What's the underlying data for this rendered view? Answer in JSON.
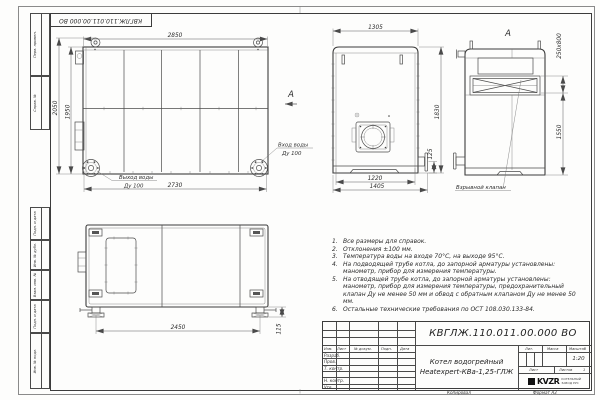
{
  "sheet": {
    "doc_number_mirrored": "КВГЛЖ.110.011.00.000 ВО",
    "copied_label": "Копировал",
    "format_label": "Формат А3"
  },
  "margin": {
    "items": [
      {
        "label": "Перв. примен."
      },
      {
        "label": "Справ. №"
      },
      {
        "label": "Подп. и дата"
      },
      {
        "label": "Инв. № дубл."
      },
      {
        "label": "Взам. инв. №"
      },
      {
        "label": "Подп. и дата"
      },
      {
        "label": "Инв. № подл."
      }
    ]
  },
  "front_view": {
    "dims": {
      "top": "2850",
      "height_outer": "2050",
      "height_body": "1950",
      "bottom": "2730"
    },
    "labels": {
      "outlet_top": "Выход воды",
      "outlet_bottom": "Ду 100",
      "inlet_top": "Вход воды",
      "inlet_bottom": "Ду 100",
      "view_arrow": "А"
    }
  },
  "side_view": {
    "dims": {
      "top": "1305",
      "height": "1830",
      "bottom_inner": "1220",
      "bottom_outer": "1405",
      "stub": "125"
    }
  },
  "rear_view": {
    "view_label": "А",
    "dims": {
      "valve": "250x800",
      "height": "1550"
    },
    "valve_label": "Взрывной клапан"
  },
  "bottom_view": {
    "dims": {
      "length": "2450",
      "foot": "115"
    }
  },
  "notes": {
    "items": [
      {
        "num": "1.",
        "text": "Все размеры для справок."
      },
      {
        "num": "2.",
        "text": "Отклонения ±100 мм."
      },
      {
        "num": "3.",
        "text": "Температура воды на входе 70°С, на выходе 95°С."
      },
      {
        "num": "4.",
        "text": "На подводящей трубе котла, до запорной арматуры установлены: манометр, прибор для измерения температуры."
      },
      {
        "num": "5.",
        "text": "На отводящей трубе котла, до запорной арматуры установлены: манометр, прибор для измерения температуры, предохранительный клапан Ду не менее 50 мм и обвод с обратным клапаном Ду не менее 50 мм."
      },
      {
        "num": "6.",
        "text": "Остальные технические требования по ОСТ 108.030.133-84."
      }
    ]
  },
  "title_block": {
    "doc_number": "КВГЛЖ.110.011.00.000 ВО",
    "name_line1": "Котел водогрейный",
    "name_line2": "Heatexpert-КВа-1,25-ГЛЖ",
    "cols": {
      "izm": "Изм.",
      "list": "Лист",
      "doc": "№ докум.",
      "podp": "Подп.",
      "data": "Дата"
    },
    "rows": {
      "razrab": "Разраб.",
      "prov": "Пров.",
      "tkontr": "Т. контр.",
      "nkontr": "Н. контр.",
      "utv": "Утв."
    },
    "lit": "Лит.",
    "massa": "Масса",
    "masshtab": "Масштаб",
    "scale": "1:20",
    "list_label": "Лист",
    "listov_label": "Листов",
    "listov_value": "1",
    "logo": "KVZR",
    "company_line1": "КОТЕЛЬНЫЙ",
    "company_line2": "ЗАВОД РУС"
  }
}
